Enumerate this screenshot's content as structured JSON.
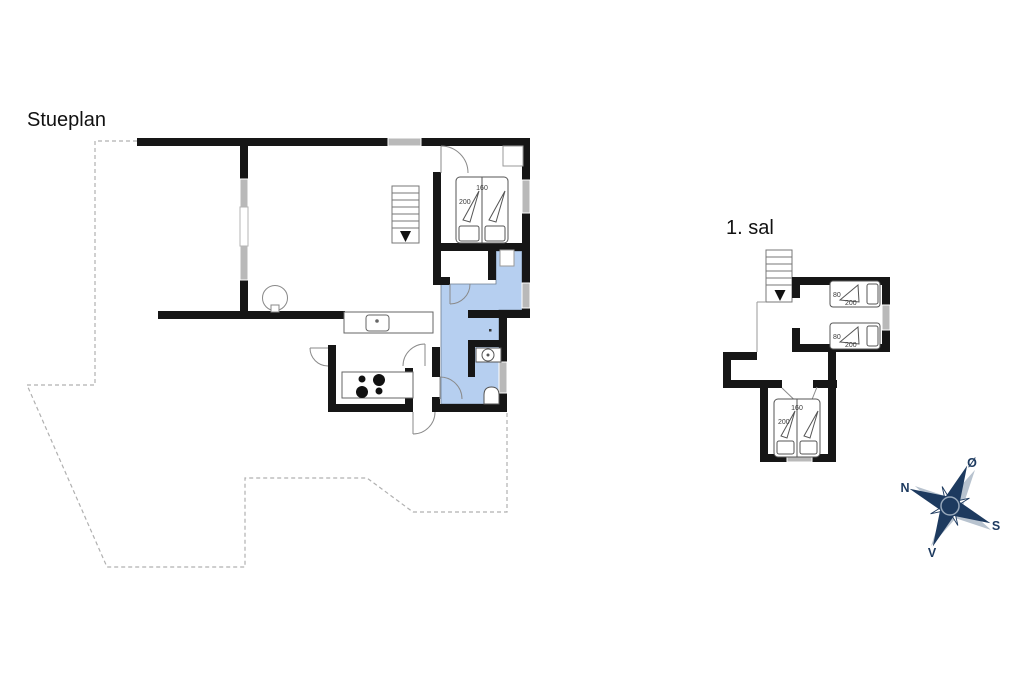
{
  "titles": {
    "ground_floor": "Stueplan",
    "first_floor": "1. sal"
  },
  "compass": {
    "north": "N",
    "east": "Ø",
    "south": "S",
    "west": "V",
    "color": "#1d3a5f"
  },
  "beds": {
    "ground_double": {
      "width": "160",
      "length": "200"
    },
    "first_double": {
      "width": "160",
      "length": "200"
    },
    "singles": [
      {
        "width": "80",
        "length": "200"
      },
      {
        "width": "80",
        "length": "200"
      }
    ]
  },
  "colors": {
    "wall": "#161616",
    "bathroom_fill": "#b6cff0",
    "window_fill": "#b9b9b9",
    "furniture_line": "#666666",
    "dashed_outline": "#b0b0b0"
  }
}
